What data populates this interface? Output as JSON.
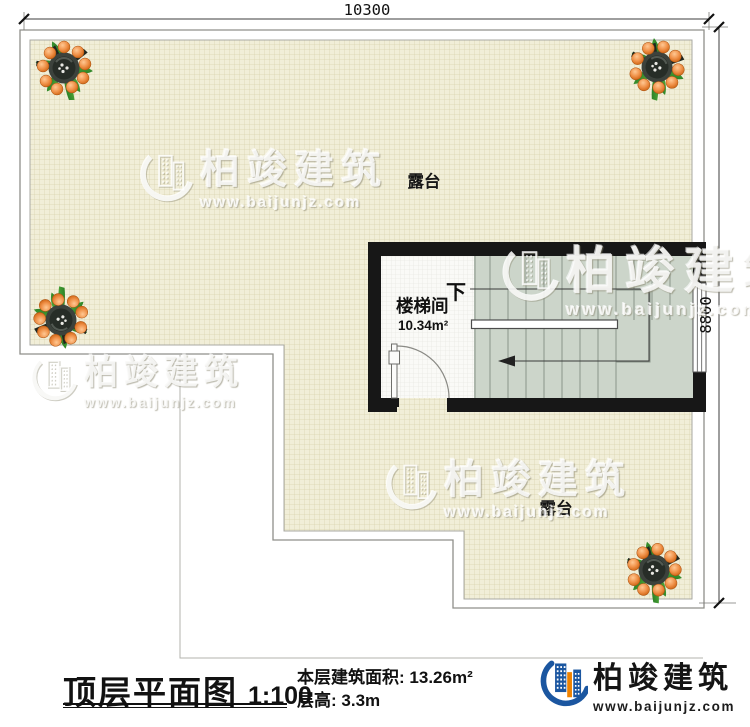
{
  "plan": {
    "dim_width": "10300",
    "dim_height": "8800",
    "terrace_label": "露台",
    "stairwell_label": "楼梯间",
    "stairwell_area": "10.34m²",
    "down_label": "下"
  },
  "watermark": {
    "brand": "柏竣建筑",
    "url": "www.baijunjz.com"
  },
  "footer": {
    "title": "顶层平面图",
    "scale": "1:100",
    "area_label": "本层建筑面积:",
    "area_value": "13.26m²",
    "height_label": "层高:",
    "height_value": "3.3m",
    "brand": "柏竣建筑",
    "brand_url": "www.baijunjz.com"
  },
  "colors": {
    "wall": "#171717",
    "terrace_fill": "#f1eed8",
    "terrace_grid": "#d9d2ae",
    "stairwell_floor": "#fafaf7",
    "stair_fill": "#ccd5ca",
    "brand_blue": "#1b56a0",
    "brand_orange": "#ef8200"
  }
}
